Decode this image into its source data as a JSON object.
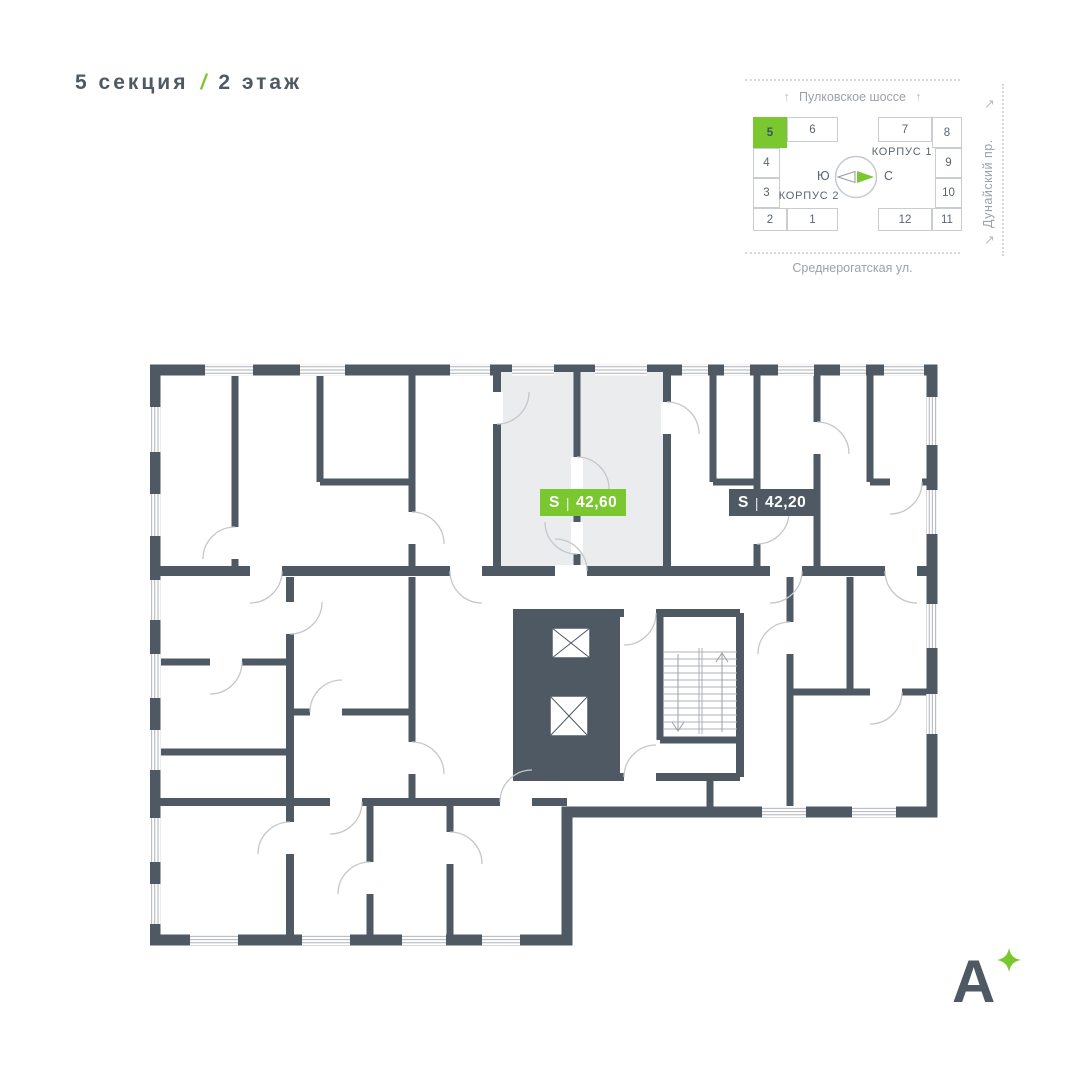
{
  "header": {
    "section": "5 секция",
    "divider": "/",
    "floor": "2 этаж"
  },
  "minimap": {
    "streets": {
      "top": "Пулковское шоссе",
      "right": "Дунайский пр.",
      "bottom": "Среднерогатская ул."
    },
    "arrows": {
      "up": "↑",
      "diag": "↗"
    },
    "buildings": [
      {
        "name": "КОРПУС 1"
      },
      {
        "name": "КОРПУС 2"
      }
    ],
    "compass": {
      "west": "Ю",
      "east": "С"
    },
    "selected_section": "5",
    "cells": {
      "c1": "1",
      "c2": "2",
      "c3": "3",
      "c4": "4",
      "c5": "5",
      "c6": "6",
      "c7": "7",
      "c8": "8",
      "c9": "9",
      "c10": "10",
      "c11": "11",
      "c12": "12"
    }
  },
  "plan": {
    "badges": {
      "selected": {
        "label": "S",
        "sep": "|",
        "value": "42,60"
      },
      "other": {
        "label": "S",
        "sep": "|",
        "value": "42,20"
      }
    }
  },
  "logo": {
    "letter": "А"
  },
  "colors": {
    "accent_green": "#7BC72F",
    "slate": "#4E5964",
    "highlight_fill": "#EBECEE",
    "muted_gray": "#9CA2A8"
  }
}
